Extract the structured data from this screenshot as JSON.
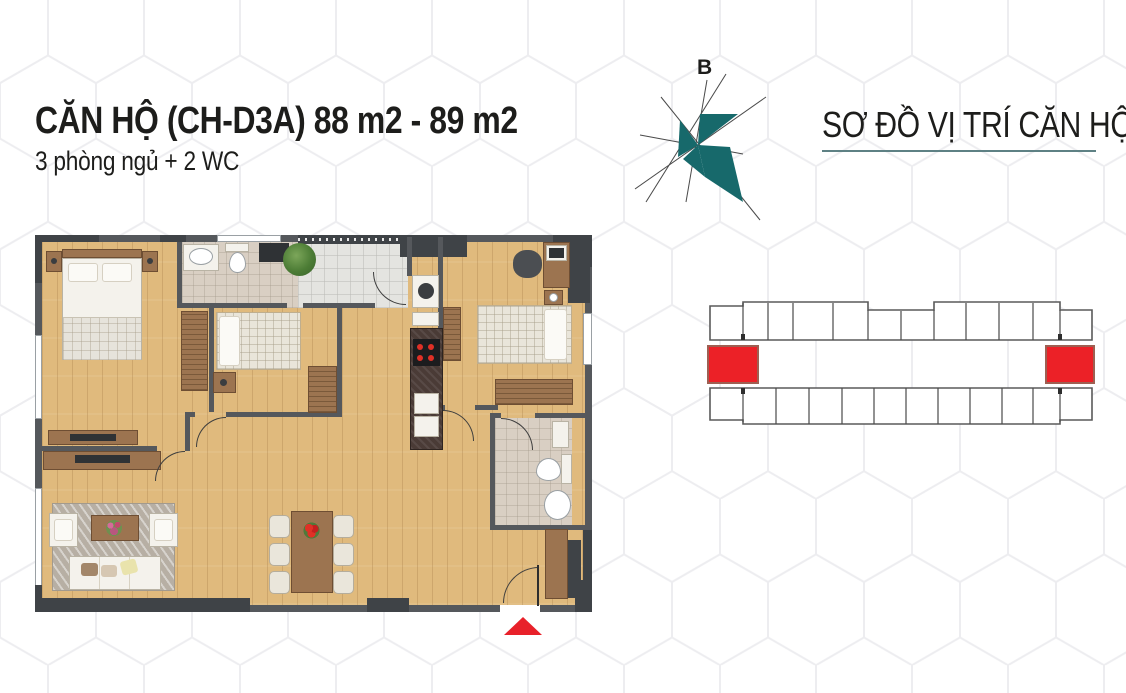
{
  "header": {
    "title": "CĂN HỘ (CH-D3A) 88 m2 - 89 m2",
    "subtitle": "3 phòng ngủ + 2 WC"
  },
  "compass": {
    "north_label": "B",
    "accent_color": "#17696b"
  },
  "location_map": {
    "heading": "SƠ ĐỒ VỊ TRÍ CĂN HỘ",
    "underline_color": "#5e8184",
    "highlight_color": "#ec2127",
    "top_row_units": 11,
    "bottom_row_units": 11,
    "highlighted_units": [
      "left-end",
      "right-end"
    ]
  },
  "floor_plan": {
    "wall_color": "#55585c",
    "floor_color": "#e0ba7d",
    "entrance_marker_color": "#e8212a",
    "rooms": [
      "master-bedroom",
      "bedroom-2",
      "bedroom-3",
      "bathroom-1",
      "bathroom-2",
      "kitchen",
      "living-room",
      "dining-area",
      "balcony",
      "entry"
    ]
  }
}
